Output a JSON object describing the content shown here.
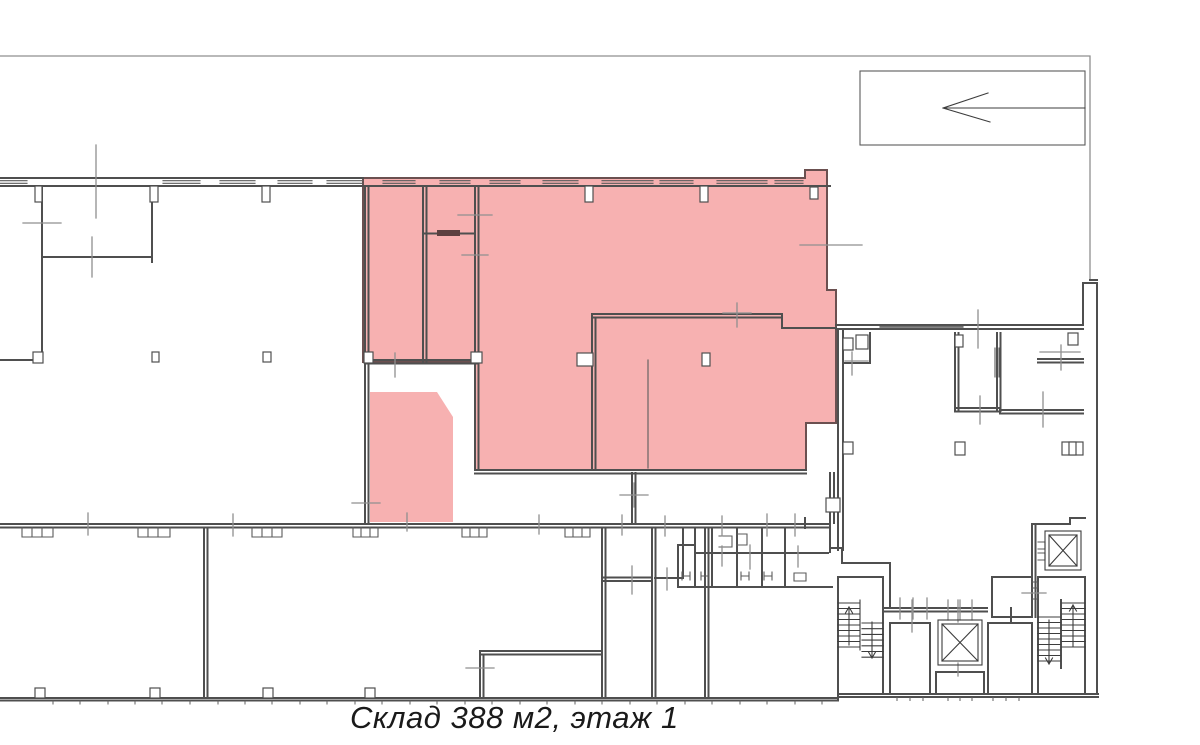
{
  "caption": {
    "text": "Склад 388 м2, этаж 1",
    "area_m2": "388",
    "floor": "1",
    "type_label": "Склад"
  },
  "colors": {
    "highlight_fill": "#F7B1B1",
    "wall_dark": "#4F4F4F",
    "axis_gray": "#8F8F8F",
    "background": "#FFFFFF",
    "caption_text": "#1A1A1A"
  },
  "icons": {
    "direction_arrow": "arrow pointing left inside top-right box",
    "elevator": "square shaft with X diagonals",
    "staircase": "parallel treads with up/down arrows"
  }
}
